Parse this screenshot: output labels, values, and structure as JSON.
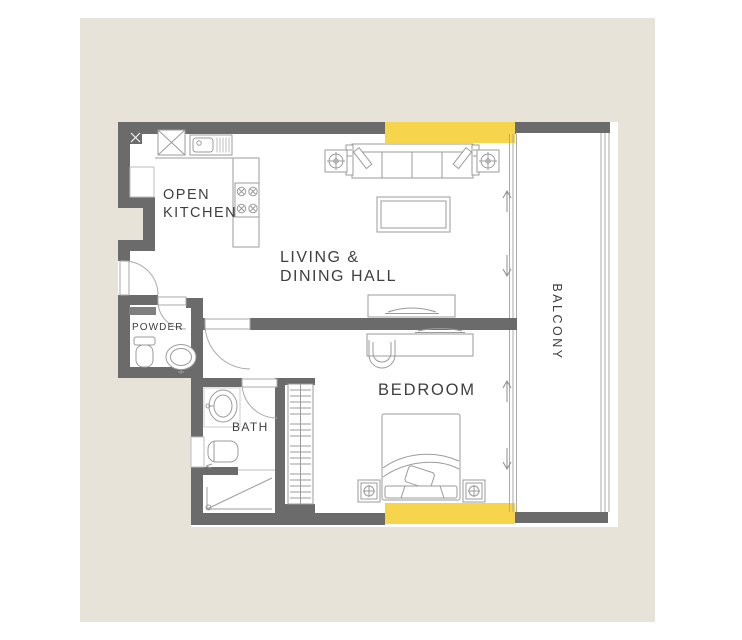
{
  "plan": {
    "title": "apartment-floor-plan",
    "colors": {
      "paper": "#ffffff",
      "mat": "#e8e3d9",
      "wall": "#6b6b6b",
      "accent": "#f6d44c",
      "line": "#9b9b9b",
      "line_light": "#bdbdbd",
      "arrow": "#8c8c8c",
      "text": "#3f3f3f"
    },
    "labels": {
      "open_kitchen_line1": "OPEN",
      "open_kitchen_line2": "KITCHEN",
      "living_line1": "LIVING &",
      "living_line2": "DINING HALL",
      "powder": "POWDER",
      "bath": "BATH",
      "bedroom": "BEDROOM",
      "balcony": "BALCONY"
    },
    "icons": {
      "washing_machine": "boxed-x",
      "fridge": "boxed-x",
      "sink": "bowl-with-drainboard",
      "hob": "four-burners",
      "floor_lamp": "square-crosshair",
      "bedside_lamp": "square-crosshair",
      "sliding_door": "double-arrow",
      "windows": "yellow-band"
    }
  }
}
